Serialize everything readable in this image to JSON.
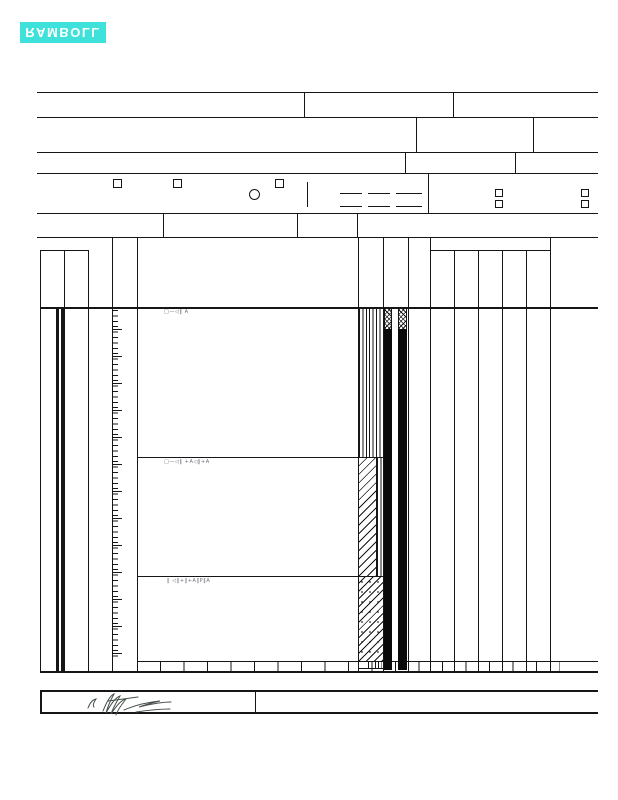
{
  "logo": {
    "text": "RAMBOLL",
    "bg": "#3ee2da",
    "fg": "#ffffff"
  },
  "annotations": {
    "stratum_mark_1": "□—◁‖ A",
    "stratum_mark_2": "□—◁‖ +A◁‖+A",
    "stratum_mark_3": "‖ ◁‖+‖+A‖P‖A"
  },
  "colors": {
    "line": "#161616",
    "annotation": "#6a6f78",
    "signature": "#46514a",
    "fill_bar": "#0a0a0a"
  }
}
